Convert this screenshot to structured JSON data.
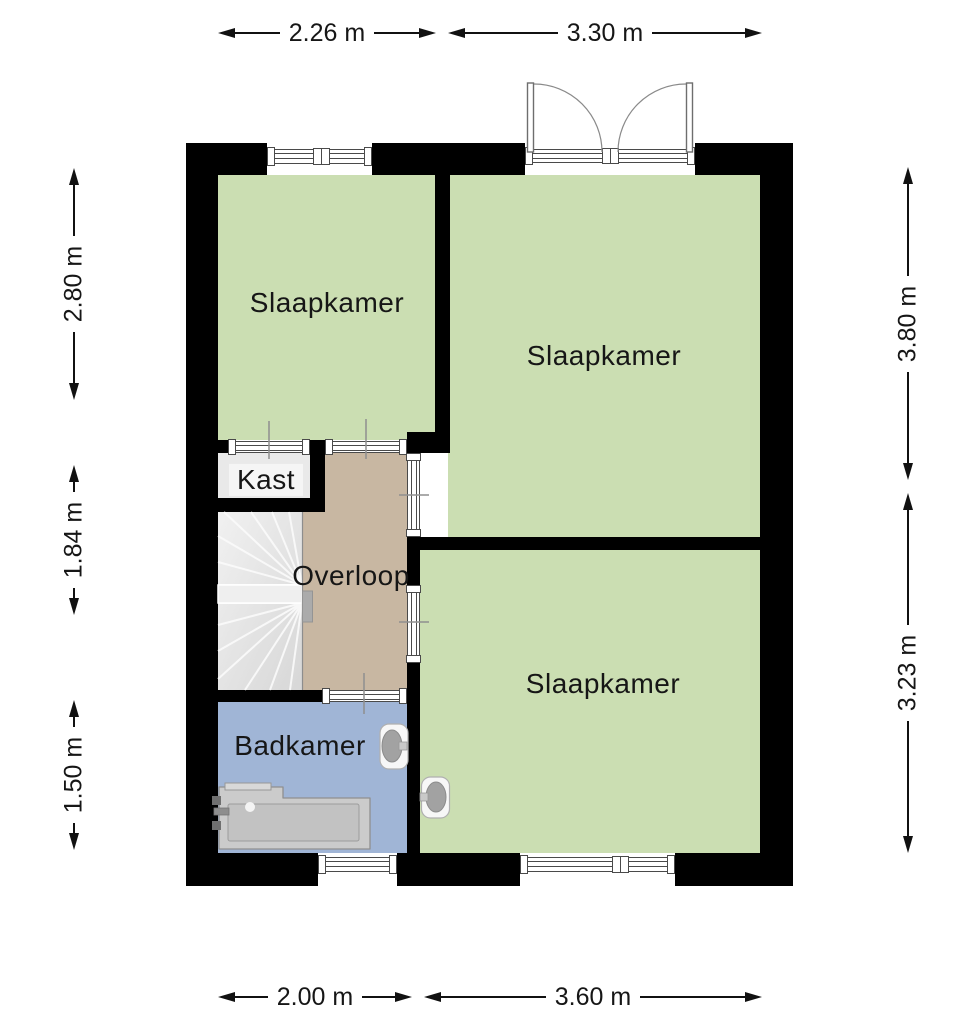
{
  "rooms": {
    "slaapkamer_top_left": {
      "label": "Slaapkamer"
    },
    "slaapkamer_top_right": {
      "label": "Slaapkamer"
    },
    "slaapkamer_bottom_right": {
      "label": "Slaapkamer"
    },
    "kast": {
      "label": "Kast"
    },
    "overloop": {
      "label": "Overloop"
    },
    "badkamer": {
      "label": "Badkamer"
    }
  },
  "dimensions": {
    "top": [
      {
        "value": "2.26 m"
      },
      {
        "value": "3.30 m"
      }
    ],
    "left": [
      {
        "value": "2.80 m"
      },
      {
        "value": "1.84 m"
      },
      {
        "value": "1.50 m"
      }
    ],
    "right": [
      {
        "value": "3.80 m"
      },
      {
        "value": "3.23 m"
      }
    ],
    "bottom": [
      {
        "value": "2.00 m"
      },
      {
        "value": "3.60 m"
      }
    ]
  },
  "colors": {
    "room_green": "#cbdeb2",
    "hallway_tan": "#c8b7a2",
    "bathroom_blue": "#a0b5d6",
    "closet_gray": "#e9e9e9",
    "wall_black": "#000000"
  },
  "fixtures": [
    {
      "name": "winder-staircase"
    },
    {
      "name": "stair-handrail"
    },
    {
      "name": "french-double-doors"
    },
    {
      "name": "bathtub"
    },
    {
      "name": "washbasin-bathroom"
    },
    {
      "name": "washbasin-bedroom"
    },
    {
      "name": "window-top-bedroom"
    },
    {
      "name": "window-bathroom"
    },
    {
      "name": "window-bottom-bedroom"
    }
  ]
}
